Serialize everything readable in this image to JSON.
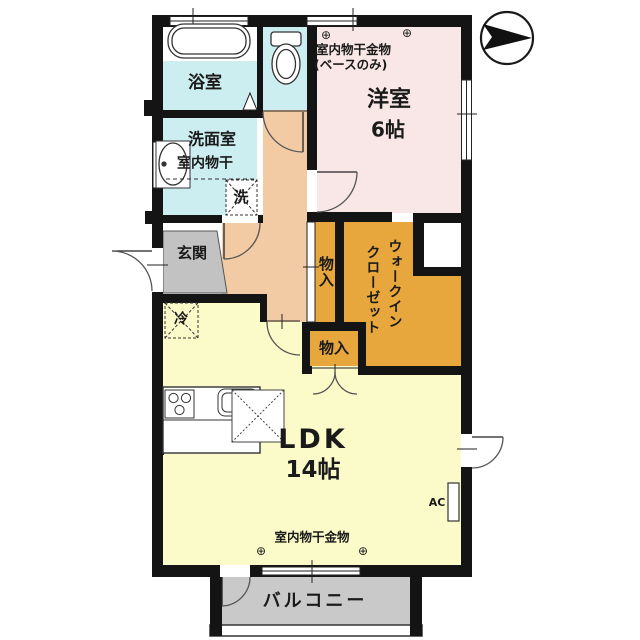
{
  "title": "floor-plan",
  "colors": {
    "wall": "#141414",
    "sanitary": "#cdeef0",
    "western_room": "#f9e7e7",
    "hallway": "#f2cba4",
    "entrance": "#c2c2c2",
    "closet": "#e7a73d",
    "ldk": "#fbfbc9",
    "balcony": "#c9c9c9",
    "fixture": "#ffffff"
  },
  "labels": {
    "bath": "浴室",
    "washroom": "洗面室",
    "washroom_note": "室内物干",
    "washer": "洗",
    "entrance": "玄関",
    "western_room": "洋室",
    "western_size": "6帖",
    "western_note1": "室内物干金物",
    "western_note2": "(ベースのみ)",
    "closet_upper": "物入",
    "wic_line1": "ウォークイン",
    "wic_line2": "クローゼット",
    "closet_lower": "物入",
    "fridge": "冷",
    "ldk": "LDK",
    "ldk_size": "14帖",
    "ldk_note": "室内物干金物",
    "ac": "AC",
    "balcony": "バルコニー",
    "anchor_symbol": "⊕"
  }
}
